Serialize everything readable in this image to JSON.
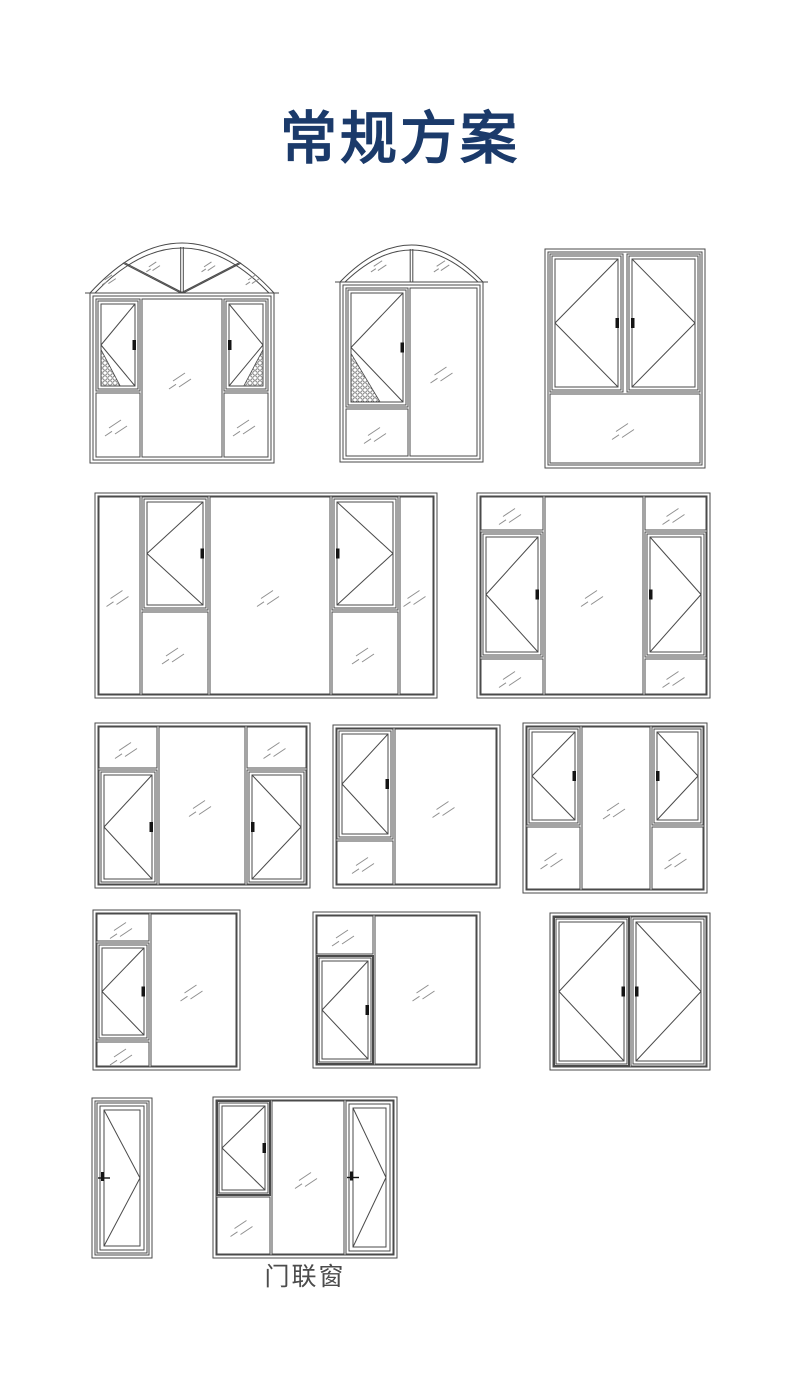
{
  "page": {
    "title": "常规方案",
    "caption": "门联窗",
    "title_color": "#1b3a6a",
    "caption_color": "#4c4c4c",
    "bg": "#ffffff",
    "line_color": "#4a4a4a",
    "glass_color": "#8f8f8f",
    "handle_color": "#141414"
  },
  "diagrams": [
    {
      "name": "arched-window-two-casements",
      "x": 90,
      "y": 243,
      "w": 184,
      "h": 220,
      "arch": {
        "h": 50,
        "segments": 4
      },
      "panes": [
        {
          "kind": "casement",
          "x": 6,
          "y": 56,
          "w": 44,
          "h": 92,
          "apex": "left",
          "handle": "right",
          "mesh": "bl"
        },
        {
          "kind": "fixed",
          "x": 6,
          "y": 150,
          "w": 44,
          "h": 64
        },
        {
          "kind": "fixed",
          "x": 52,
          "y": 56,
          "w": 80,
          "h": 158
        },
        {
          "kind": "casement",
          "x": 134,
          "y": 56,
          "w": 44,
          "h": 92,
          "apex": "right",
          "handle": "left",
          "mesh": "br"
        },
        {
          "kind": "fixed",
          "x": 134,
          "y": 150,
          "w": 44,
          "h": 64
        }
      ]
    },
    {
      "name": "arched-window-single-casement",
      "x": 340,
      "y": 245,
      "w": 143,
      "h": 217,
      "arch": {
        "h": 37,
        "segments": 2
      },
      "panes": [
        {
          "kind": "casement",
          "x": 6,
          "y": 43,
          "w": 62,
          "h": 119,
          "apex": "left",
          "handle": "right",
          "mesh": "bl"
        },
        {
          "kind": "fixed",
          "x": 6,
          "y": 164,
          "w": 62,
          "h": 47
        },
        {
          "kind": "fixed",
          "x": 70,
          "y": 43,
          "w": 67,
          "h": 168
        }
      ]
    },
    {
      "name": "double-casement-window-bottom-fixed",
      "x": 545,
      "y": 249,
      "w": 160,
      "h": 219,
      "panes": [
        {
          "kind": "casement",
          "x": 5,
          "y": 5,
          "w": 73,
          "h": 138,
          "apex": "left",
          "handle": "right"
        },
        {
          "kind": "casement",
          "x": 82,
          "y": 5,
          "w": 73,
          "h": 138,
          "apex": "right",
          "handle": "left"
        },
        {
          "kind": "fixed",
          "x": 5,
          "y": 145,
          "w": 150,
          "h": 69
        }
      ]
    },
    {
      "name": "wide-five-column-window-two-casements",
      "x": 95,
      "y": 493,
      "w": 342,
      "h": 205,
      "panes": [
        {
          "kind": "fixed",
          "x": 4,
          "y": 4,
          "w": 41,
          "h": 197
        },
        {
          "kind": "casement",
          "x": 47,
          "y": 4,
          "w": 66,
          "h": 113,
          "apex": "left",
          "handle": "right"
        },
        {
          "kind": "fixed",
          "x": 47,
          "y": 119,
          "w": 66,
          "h": 82
        },
        {
          "kind": "fixed",
          "x": 115,
          "y": 4,
          "w": 120,
          "h": 197
        },
        {
          "kind": "casement",
          "x": 237,
          "y": 4,
          "w": 66,
          "h": 113,
          "apex": "right",
          "handle": "left"
        },
        {
          "kind": "fixed",
          "x": 237,
          "y": 119,
          "w": 66,
          "h": 82
        },
        {
          "kind": "fixed",
          "x": 305,
          "y": 4,
          "w": 33,
          "h": 197
        }
      ]
    },
    {
      "name": "three-column-window-casements-mid-fixed-top-bottom",
      "x": 477,
      "y": 493,
      "w": 233,
      "h": 205,
      "panes": [
        {
          "kind": "fixed",
          "x": 4,
          "y": 4,
          "w": 62,
          "h": 33
        },
        {
          "kind": "casement",
          "x": 4,
          "y": 39,
          "w": 62,
          "h": 125,
          "apex": "left",
          "handle": "right"
        },
        {
          "kind": "fixed",
          "x": 4,
          "y": 166,
          "w": 62,
          "h": 35
        },
        {
          "kind": "fixed",
          "x": 68,
          "y": 4,
          "w": 98,
          "h": 197
        },
        {
          "kind": "fixed",
          "x": 168,
          "y": 4,
          "w": 61,
          "h": 33
        },
        {
          "kind": "casement",
          "x": 168,
          "y": 39,
          "w": 61,
          "h": 125,
          "apex": "right",
          "handle": "left"
        },
        {
          "kind": "fixed",
          "x": 168,
          "y": 166,
          "w": 61,
          "h": 35
        }
      ]
    },
    {
      "name": "three-column-window-top-fixed-casements",
      "x": 95,
      "y": 723,
      "w": 215,
      "h": 165,
      "panes": [
        {
          "kind": "fixed",
          "x": 4,
          "y": 4,
          "w": 58,
          "h": 41
        },
        {
          "kind": "casement",
          "x": 4,
          "y": 47,
          "w": 58,
          "h": 114,
          "apex": "left",
          "handle": "right"
        },
        {
          "kind": "fixed",
          "x": 64,
          "y": 4,
          "w": 86,
          "h": 157
        },
        {
          "kind": "fixed",
          "x": 152,
          "y": 4,
          "w": 59,
          "h": 41
        },
        {
          "kind": "casement",
          "x": 152,
          "y": 47,
          "w": 59,
          "h": 114,
          "apex": "right",
          "handle": "left"
        }
      ]
    },
    {
      "name": "two-column-window-casement-left",
      "x": 333,
      "y": 725,
      "w": 167,
      "h": 163,
      "panes": [
        {
          "kind": "casement",
          "x": 4,
          "y": 4,
          "w": 56,
          "h": 110,
          "apex": "left",
          "handle": "right"
        },
        {
          "kind": "fixed",
          "x": 4,
          "y": 116,
          "w": 56,
          "h": 43
        },
        {
          "kind": "fixed",
          "x": 62,
          "y": 4,
          "w": 101,
          "h": 155
        }
      ]
    },
    {
      "name": "three-column-window-casements-bottom-fixed",
      "x": 523,
      "y": 723,
      "w": 184,
      "h": 170,
      "panes": [
        {
          "kind": "casement",
          "x": 4,
          "y": 4,
          "w": 53,
          "h": 98,
          "apex": "left",
          "handle": "right"
        },
        {
          "kind": "fixed",
          "x": 4,
          "y": 104,
          "w": 53,
          "h": 62
        },
        {
          "kind": "fixed",
          "x": 59,
          "y": 4,
          "w": 68,
          "h": 162
        },
        {
          "kind": "casement",
          "x": 129,
          "y": 4,
          "w": 51,
          "h": 98,
          "apex": "right",
          "handle": "left"
        },
        {
          "kind": "fixed",
          "x": 129,
          "y": 104,
          "w": 51,
          "h": 62
        }
      ]
    },
    {
      "name": "two-column-window-casement-between-fixed",
      "x": 93,
      "y": 910,
      "w": 147,
      "h": 160,
      "panes": [
        {
          "kind": "fixed",
          "x": 4,
          "y": 4,
          "w": 52,
          "h": 27
        },
        {
          "kind": "casement",
          "x": 4,
          "y": 33,
          "w": 52,
          "h": 97,
          "apex": "left",
          "handle": "right"
        },
        {
          "kind": "fixed",
          "x": 4,
          "y": 132,
          "w": 52,
          "h": 24
        },
        {
          "kind": "fixed",
          "x": 58,
          "y": 4,
          "w": 85,
          "h": 152
        }
      ]
    },
    {
      "name": "two-column-window-top-fixed-casement",
      "x": 313,
      "y": 912,
      "w": 167,
      "h": 156,
      "panes": [
        {
          "kind": "fixed",
          "x": 4,
          "y": 4,
          "w": 56,
          "h": 38
        },
        {
          "kind": "casement",
          "x": 4,
          "y": 44,
          "w": 56,
          "h": 108,
          "apex": "left",
          "handle": "right",
          "bold": true
        },
        {
          "kind": "fixed",
          "x": 62,
          "y": 4,
          "w": 101,
          "h": 148
        }
      ]
    },
    {
      "name": "double-casement-window",
      "x": 550,
      "y": 913,
      "w": 160,
      "h": 157,
      "panes": [
        {
          "kind": "casement",
          "x": 4,
          "y": 4,
          "w": 75,
          "h": 149,
          "apex": "left",
          "handle": "right",
          "bold": true
        },
        {
          "kind": "casement",
          "x": 81,
          "y": 4,
          "w": 75,
          "h": 149,
          "apex": "right",
          "handle": "left"
        }
      ]
    },
    {
      "name": "single-swing-door",
      "x": 92,
      "y": 1098,
      "w": 60,
      "h": 160,
      "panes": [
        {
          "kind": "door",
          "x": 5,
          "y": 5,
          "w": 50,
          "h": 150,
          "apex": "right",
          "handle": "left"
        }
      ]
    },
    {
      "name": "door-connected-window",
      "x": 213,
      "y": 1097,
      "w": 184,
      "h": 161,
      "panes": [
        {
          "kind": "casement",
          "x": 4,
          "y": 4,
          "w": 53,
          "h": 94,
          "apex": "left",
          "handle": "right",
          "bold": true
        },
        {
          "kind": "fixed",
          "x": 4,
          "y": 100,
          "w": 53,
          "h": 57
        },
        {
          "kind": "fixed",
          "x": 59,
          "y": 4,
          "w": 72,
          "h": 153
        },
        {
          "kind": "door",
          "x": 133,
          "y": 4,
          "w": 47,
          "h": 153,
          "apex": "right",
          "handle": "left"
        }
      ]
    }
  ]
}
